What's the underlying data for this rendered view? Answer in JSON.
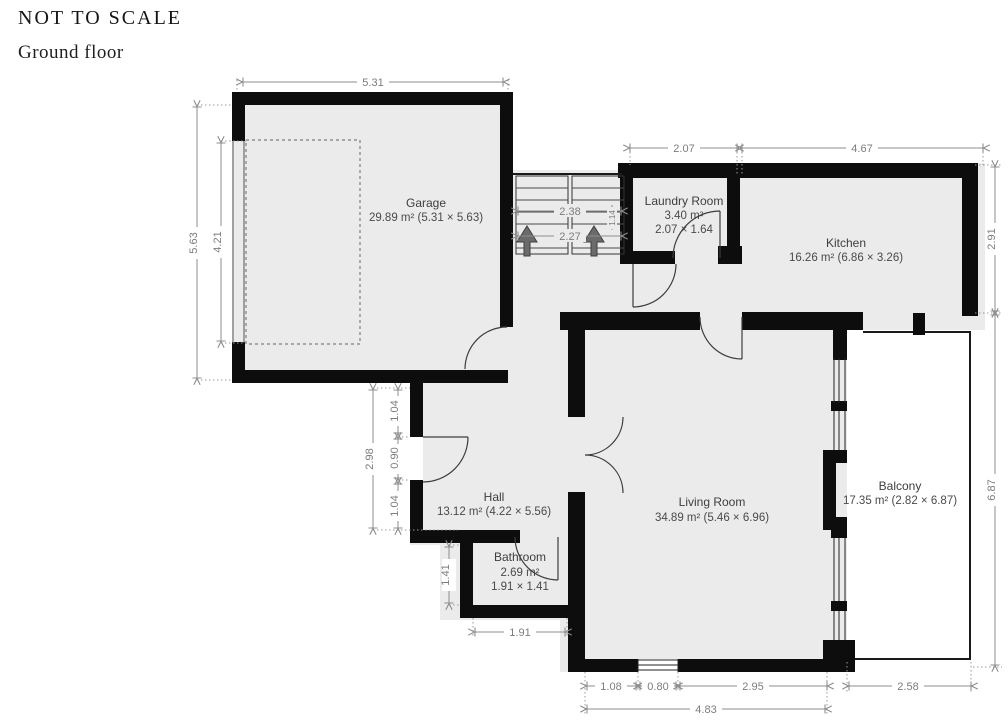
{
  "header": {
    "scale_note": "NOT TO SCALE",
    "floor_label": "Ground floor"
  },
  "rooms": {
    "garage": {
      "name": "Garage",
      "details": "29.89 m² (5.31 × 5.63)"
    },
    "laundry": {
      "name": "Laundry Room",
      "area": "3.40 m²",
      "size": "2.07 × 1.64"
    },
    "kitchen": {
      "name": "Kitchen",
      "details": "16.26 m² (6.86 × 3.26)"
    },
    "hall": {
      "name": "Hall",
      "details": "13.12 m² (4.22 × 5.56)"
    },
    "bathroom": {
      "name": "Bathroom",
      "area": "2.69 m²",
      "size": "1.91 × 1.41"
    },
    "living_room": {
      "name": "Living Room",
      "details": "34.89 m² (5.46 × 6.96)"
    },
    "balcony": {
      "name": "Balcony",
      "details": "17.35 m² (2.82 × 6.87)"
    }
  },
  "measurements": {
    "garage_width": "5.31",
    "garage_depth": "5.63",
    "garage_inner_depth": "4.21",
    "stairs_upper": "2.38",
    "stairs_lower": "2.27",
    "stairs_width": "1.14",
    "laundry_width": "2.07",
    "kitchen_width": "4.67",
    "kitchen_depth": "2.91",
    "balcony_depth": "6.87",
    "balcony_width": "2.58",
    "hall_left_total": "2.98",
    "hall_left_upper": "1.04",
    "front_door_width": "0.90",
    "hall_left_lower": "1.04",
    "bathroom_depth": "1.41",
    "bathroom_width": "1.91",
    "living_bottom_left": "1.08",
    "living_window_width": "0.80",
    "living_bottom_right": "2.95",
    "living_bottom_total": "4.83"
  },
  "colors": {
    "wall": "#0d0d0d",
    "room_fill": "#ebebeb",
    "balcony_fill": "#ffffff",
    "dimension": "#8c8c8c",
    "label_text": "#3e3e3e"
  }
}
